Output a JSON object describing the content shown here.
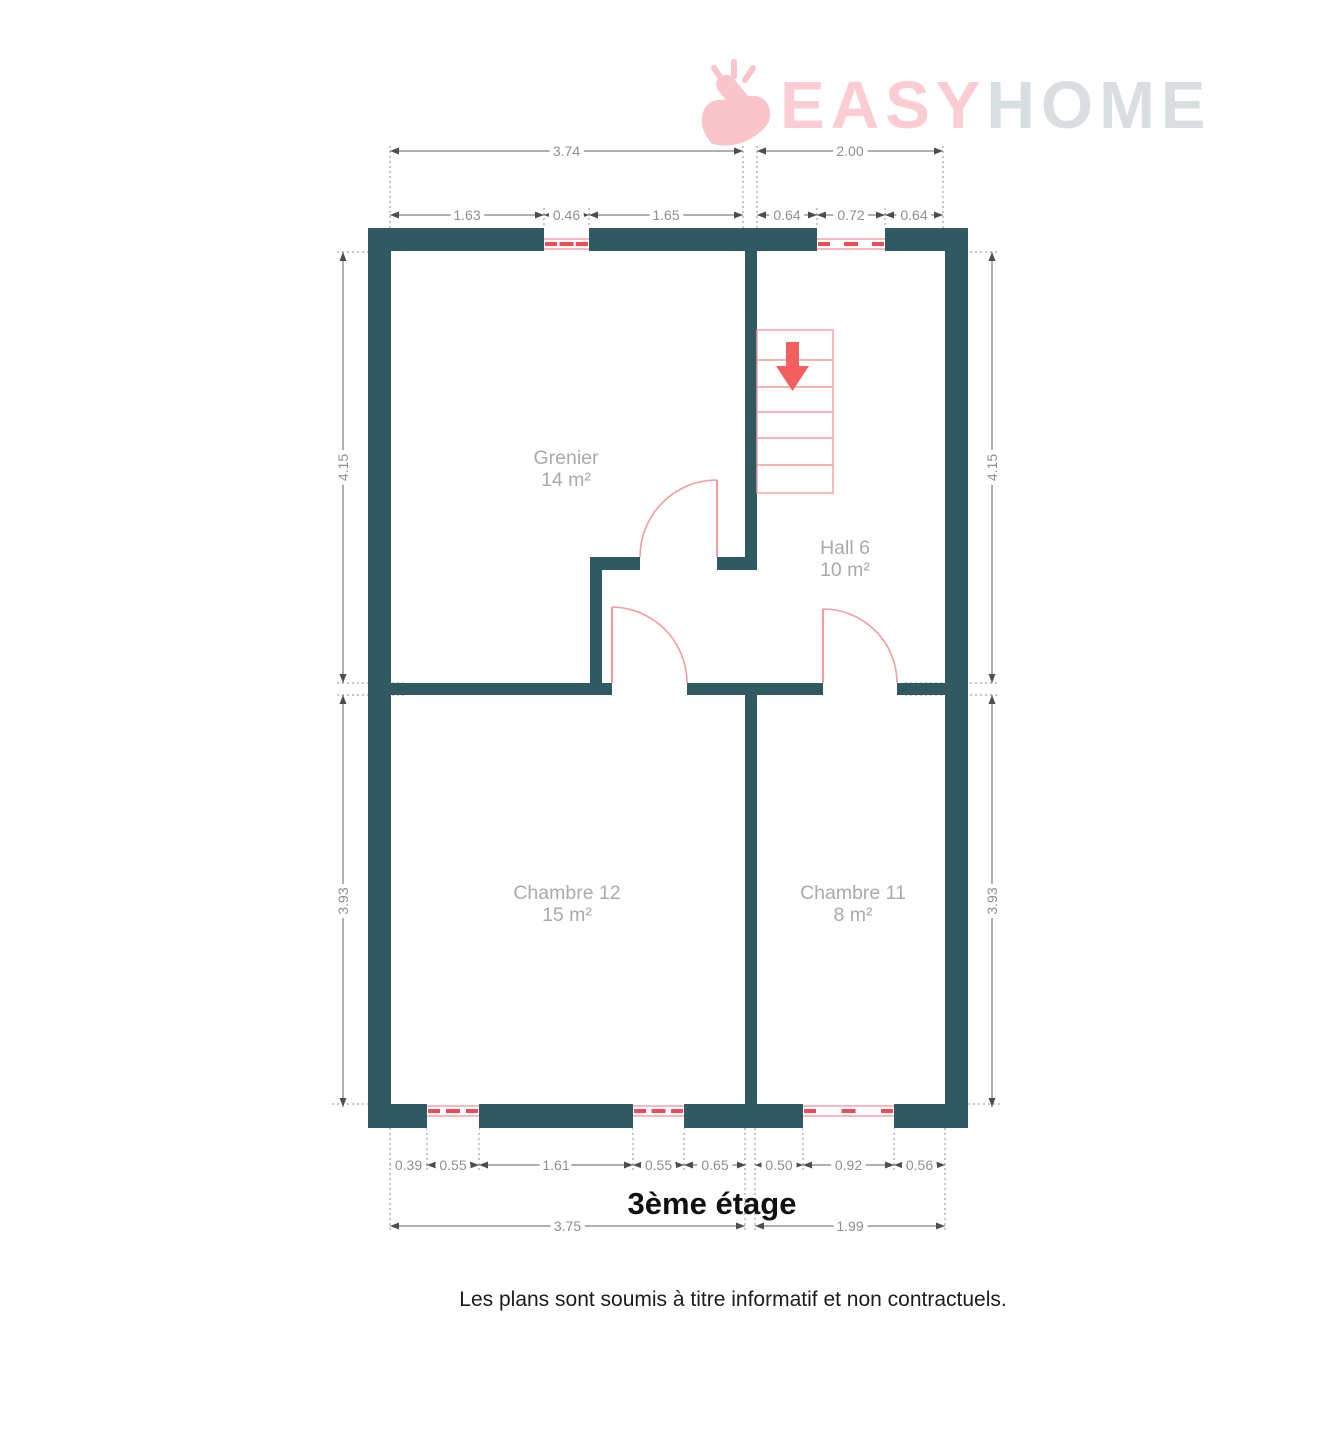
{
  "logo": {
    "part_pink": "EASY",
    "part_gray": "HOME"
  },
  "title": "3ème étage",
  "disclaimer": "Les plans sont soumis à titre informatif et non contractuels.",
  "colors": {
    "wall": "#315962",
    "accent_red": "#f15f5f",
    "accent_light": "#f59c9c",
    "logo_pink": "#fbccd3",
    "logo_gray": "#d9dee1",
    "dim_text": "#8f8f8f",
    "room_text": "#a7abab"
  },
  "rooms": [
    {
      "name": "Grenier",
      "area": "14 m²",
      "x": 566,
      "y": 464
    },
    {
      "name": "Hall 6",
      "area": "10 m²",
      "x": 845,
      "y": 554
    },
    {
      "name": "Chambre 12",
      "area": "15 m²",
      "x": 567,
      "y": 899
    },
    {
      "name": "Chambre 11",
      "area": "8 m²",
      "x": 853,
      "y": 899
    }
  ],
  "plan": {
    "walls": [
      [
        368,
        228,
        600,
        23
      ],
      [
        368,
        1104,
        600,
        24
      ],
      [
        368,
        228,
        23,
        900
      ],
      [
        945,
        228,
        23,
        900
      ],
      [
        745,
        251,
        12,
        319
      ],
      [
        590,
        557,
        50,
        13
      ],
      [
        717,
        557,
        40,
        13
      ],
      [
        590,
        570,
        12,
        113
      ],
      [
        391,
        683,
        221,
        12
      ],
      [
        687,
        683,
        136,
        12
      ],
      [
        897,
        683,
        48,
        12
      ],
      [
        745,
        695,
        12,
        409
      ]
    ],
    "windows": [
      {
        "x": 544,
        "w": 45,
        "wy": 228,
        "wh": 23,
        "side": "top"
      },
      {
        "x": 817,
        "w": 68,
        "wy": 228,
        "wh": 23,
        "side": "top"
      },
      {
        "x": 427,
        "w": 52,
        "wy": 1104,
        "wh": 24,
        "side": "bottom"
      },
      {
        "x": 633,
        "w": 51,
        "wy": 1104,
        "wh": 24,
        "side": "bottom"
      },
      {
        "x": 803,
        "w": 91,
        "wy": 1104,
        "wh": 24,
        "side": "bottom"
      }
    ],
    "stairs": {
      "x": 757,
      "y": 330,
      "w": 76,
      "h": 163,
      "treads": [
        360,
        387,
        412,
        438,
        465
      ],
      "arrow_shaft": [
        786,
        342,
        13,
        26
      ],
      "arrow_head": "776,366 809,366 792.5,391"
    },
    "doors": [
      {
        "leaf": [
          717,
          480,
          717,
          557
        ],
        "arc": "M640,557 A77,77 0 0 1 717,480"
      },
      {
        "leaf": [
          612,
          607,
          612,
          683
        ],
        "arc": "M687,683 A76,76 0 0 0 612,607"
      },
      {
        "leaf": [
          823,
          609,
          823,
          683
        ],
        "arc": "M897,683 A74,74 0 0 0 823,609"
      }
    ],
    "dims_h": [
      {
        "label": "3.74",
        "x1": 390,
        "x2": 743,
        "y": 151
      },
      {
        "label": "2.00",
        "x1": 757,
        "x2": 943,
        "y": 151
      },
      {
        "label": "1.63",
        "x1": 390,
        "x2": 544,
        "y": 215
      },
      {
        "label": "0.46",
        "x1": 544,
        "x2": 589,
        "y": 215
      },
      {
        "label": "1.65",
        "x1": 589,
        "x2": 743,
        "y": 215
      },
      {
        "label": "0.64",
        "x1": 757,
        "x2": 817,
        "y": 215
      },
      {
        "label": "0.72",
        "x1": 817,
        "x2": 885,
        "y": 215
      },
      {
        "label": "0.64",
        "x1": 885,
        "x2": 943,
        "y": 215
      },
      {
        "label": "0.39",
        "x1": 390,
        "x2": 427,
        "y": 1165
      },
      {
        "label": "0.55",
        "x1": 427,
        "x2": 479,
        "y": 1165
      },
      {
        "label": "1.61",
        "x1": 479,
        "x2": 633,
        "y": 1165
      },
      {
        "label": "0.55",
        "x1": 633,
        "x2": 684,
        "y": 1165
      },
      {
        "label": "0.65",
        "x1": 684,
        "x2": 746,
        "y": 1165
      },
      {
        "label": "0.50",
        "x1": 755,
        "x2": 803,
        "y": 1165
      },
      {
        "label": "0.92",
        "x1": 803,
        "x2": 894,
        "y": 1165
      },
      {
        "label": "0.56",
        "x1": 894,
        "x2": 945,
        "y": 1165
      },
      {
        "label": "3.75",
        "x1": 390,
        "x2": 745,
        "y": 1226
      },
      {
        "label": "1.99",
        "x1": 755,
        "x2": 945,
        "y": 1226
      }
    ],
    "dims_v": [
      {
        "label": "4.15",
        "y1": 252,
        "y2": 683,
        "x": 343
      },
      {
        "label": "3.93",
        "y1": 695,
        "y2": 1107,
        "x": 343
      },
      {
        "label": "4.15",
        "y1": 252,
        "y2": 683,
        "x": 992
      },
      {
        "label": "3.93",
        "y1": 695,
        "y2": 1107,
        "x": 992
      }
    ],
    "ext_lines": [
      {
        "x1": 390,
        "y1": 146,
        "x2": 390,
        "y2": 228
      },
      {
        "x1": 743,
        "y1": 146,
        "x2": 743,
        "y2": 228
      },
      {
        "x1": 757,
        "y1": 146,
        "x2": 757,
        "y2": 228
      },
      {
        "x1": 943,
        "y1": 146,
        "x2": 943,
        "y2": 228
      },
      {
        "x1": 544,
        "y1": 208,
        "x2": 544,
        "y2": 228
      },
      {
        "x1": 589,
        "y1": 208,
        "x2": 589,
        "y2": 228
      },
      {
        "x1": 817,
        "y1": 208,
        "x2": 817,
        "y2": 228
      },
      {
        "x1": 885,
        "y1": 208,
        "x2": 885,
        "y2": 228
      },
      {
        "x1": 337,
        "y1": 252,
        "x2": 391,
        "y2": 252
      },
      {
        "x1": 337,
        "y1": 683,
        "x2": 405,
        "y2": 683
      },
      {
        "x1": 337,
        "y1": 695,
        "x2": 405,
        "y2": 695
      },
      {
        "x1": 332,
        "y1": 1104,
        "x2": 368,
        "y2": 1104
      },
      {
        "x1": 945,
        "y1": 252,
        "x2": 998,
        "y2": 252
      },
      {
        "x1": 905,
        "y1": 683,
        "x2": 998,
        "y2": 683
      },
      {
        "x1": 905,
        "y1": 695,
        "x2": 998,
        "y2": 695
      },
      {
        "x1": 968,
        "y1": 1104,
        "x2": 1002,
        "y2": 1104
      },
      {
        "x1": 427,
        "y1": 1128,
        "x2": 427,
        "y2": 1171
      },
      {
        "x1": 479,
        "y1": 1128,
        "x2": 479,
        "y2": 1171
      },
      {
        "x1": 633,
        "y1": 1128,
        "x2": 633,
        "y2": 1171
      },
      {
        "x1": 684,
        "y1": 1128,
        "x2": 684,
        "y2": 1171
      },
      {
        "x1": 803,
        "y1": 1128,
        "x2": 803,
        "y2": 1171
      },
      {
        "x1": 894,
        "y1": 1128,
        "x2": 894,
        "y2": 1171
      },
      {
        "x1": 390,
        "y1": 1128,
        "x2": 390,
        "y2": 1232
      },
      {
        "x1": 745,
        "y1": 1128,
        "x2": 745,
        "y2": 1232
      },
      {
        "x1": 755,
        "y1": 1128,
        "x2": 755,
        "y2": 1232
      },
      {
        "x1": 945,
        "y1": 1128,
        "x2": 945,
        "y2": 1232
      }
    ]
  }
}
